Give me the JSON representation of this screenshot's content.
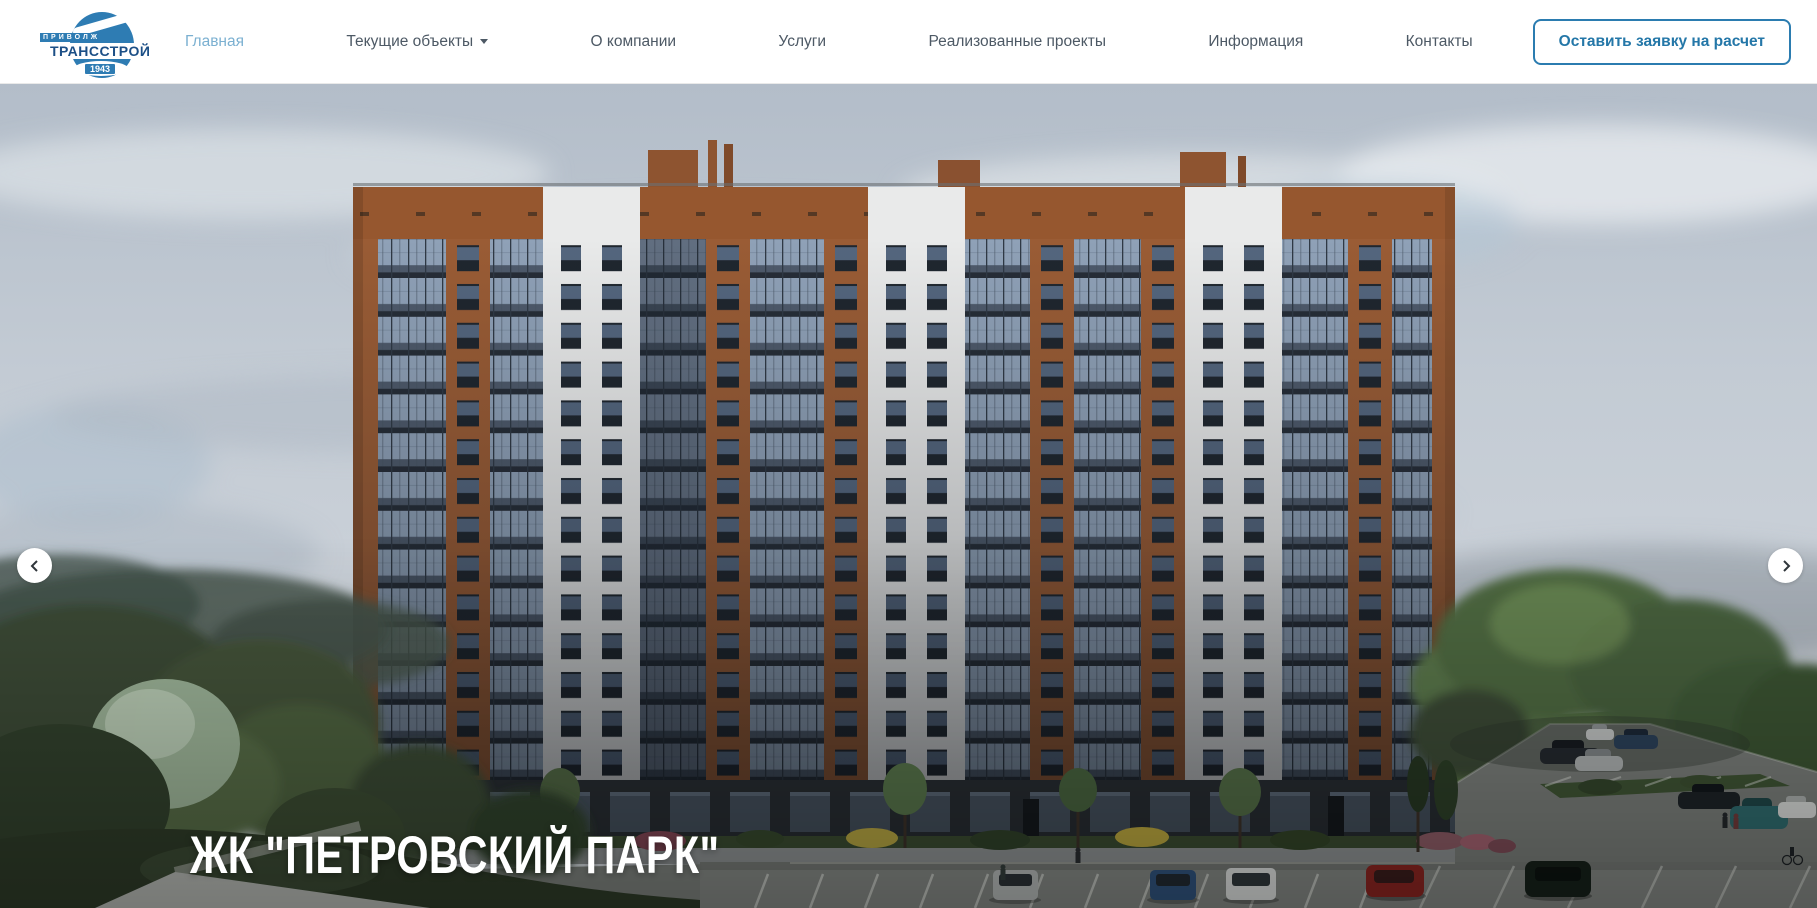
{
  "header": {
    "logo": {
      "line1": "ПРИВОЛЖ",
      "line2": "ТРАНССТРОЙ",
      "line3": "1943"
    },
    "nav": [
      {
        "label": "Главная",
        "active": true
      },
      {
        "label": "Текущие объекты",
        "has_dropdown": true
      },
      {
        "label": "О компании"
      },
      {
        "label": "Услуги"
      },
      {
        "label": "Реализованные проекты"
      },
      {
        "label": "Информация"
      },
      {
        "label": "Контакты"
      }
    ],
    "cta_label": "Оставить заявку на расчет"
  },
  "hero": {
    "title": "ЖК \"ПЕТРОВСКИЙ ПАРК\"",
    "description": "render of a multi-storey residential complex with brick and white facades, trees and parking lot"
  },
  "icons": {
    "dropdown": "caret-down",
    "prev": "chevron-left",
    "next": "chevron-right"
  },
  "colors": {
    "accent": "#2b7cb0",
    "active_link": "#7bb0d1",
    "nav_text": "#4d5965",
    "hero_title": "#ffffff"
  }
}
